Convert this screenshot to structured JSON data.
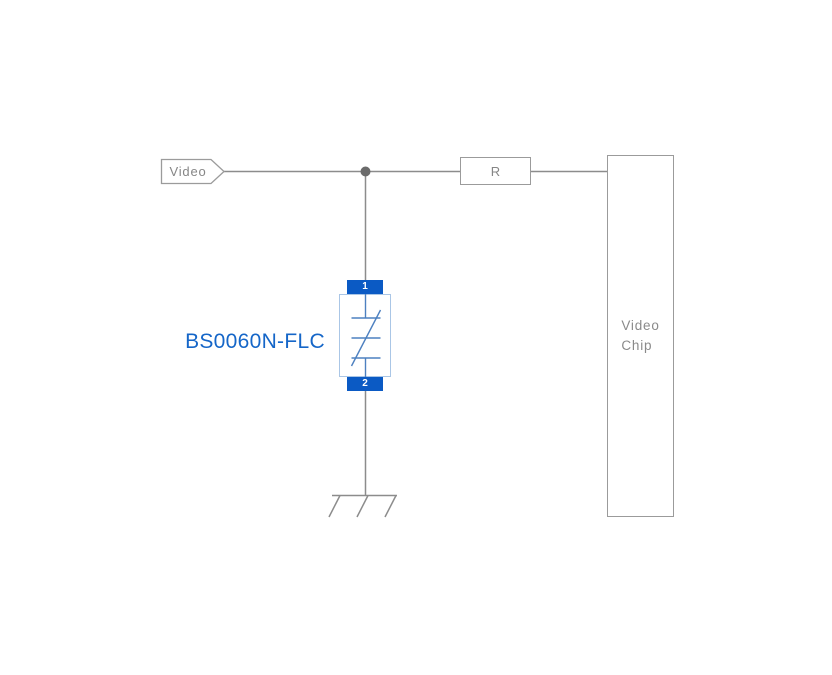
{
  "schematic": {
    "net_label": "Video",
    "resistor_label": "R",
    "chip": {
      "line1": "Video",
      "line2": "Chip"
    },
    "tvs": {
      "part_number": "BS0060N-FLC",
      "pin_top": "1",
      "pin_bottom": "2"
    },
    "colors": {
      "wire_gray": "#8c8c8c",
      "box_border_gray": "#9b9b9b",
      "label_gray": "#868686",
      "junction_gray": "#6b6b6b",
      "pad_blue": "#0b5ac4",
      "tvs_body_border_blue": "#aac6e6",
      "tvs_symbol_blue": "#4d80c0",
      "part_label_blue": "#1566c8"
    }
  }
}
